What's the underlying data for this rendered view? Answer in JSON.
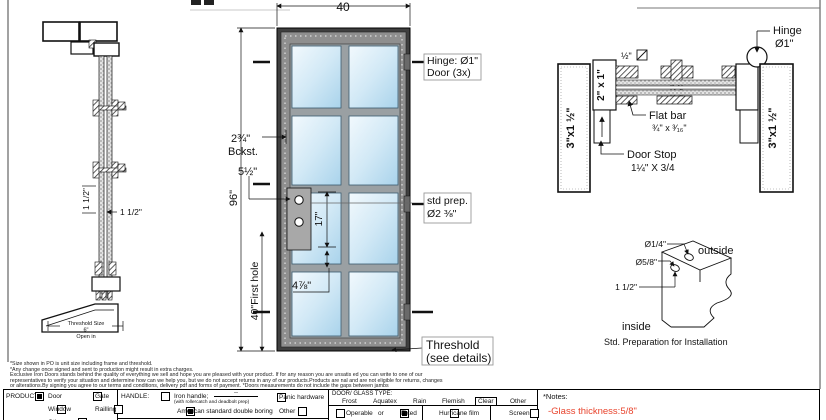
{
  "colors": {
    "frame_dark": "#3f3f3f",
    "frame_face": "#8f8f8f",
    "glass_light": "#f2f9fd",
    "glass_dark": "#a9d3eb",
    "note_red": "#e8432c"
  },
  "drawing": {
    "left": {
      "v_dim": "1 1/2\"",
      "h_dim": "1 1/2\"",
      "th1": "Threshold Size",
      "th2": "6\"",
      "th3": "Open in"
    },
    "door": {
      "dim_w": "40",
      "dim_h": "96\"",
      "backset_v": "2¾\"",
      "backset_l": "Bckst.",
      "off55": "5½\"",
      "d17": "17\"",
      "d478": "4⅞\"",
      "first_hole": "40\"First hole",
      "hinge1": "Hinge: Ø1\"",
      "hinge2": "Door (3x)",
      "prep1": "std prep.",
      "prep2": "Ø2 ⅜\"",
      "thr1": "Threshold",
      "thr2": "(see details)"
    },
    "plan": {
      "jamb_l": "3\"x1 ½\"",
      "jamb_r": "3\"x1 ½\"",
      "tube": "2\" x 1\"",
      "half": "½\"",
      "flat1": "Flat bar",
      "flat2": "¾\" x ³⁄₁₆\"",
      "stop1": "Door Stop",
      "stop2": "1¼\" X 3/4",
      "hinge1": "Hinge",
      "hinge2": "Ø1\""
    },
    "detail": {
      "dia14": "Ø1/4\"",
      "dia58": "Ø5/8\"",
      "d112": "1 1/2\"",
      "outside": "outside",
      "inside": "inside",
      "caption": "Std. Preparation for Installation"
    }
  },
  "fine_print": {
    "l1": "*Size shown in PO is unit size including frame and threshold.",
    "l2": "*Any change once signed and sent to production might result in extra charges.",
    "l3": "Exclusive Iron Doors stands behind the quality of everything we sell and hope you are pleased with your product. If for any reason you are unsatis ed you can write to one of our",
    "l4": "representatives to verify your situation and determine how can we help you, but we do not accept returns in any of our products.Products are  nal and are not eligible for returns, changes",
    "l5": "or alterations.By signing you agree to our terms and conditions, delivery pdf and forms of payment. *Doors measurements do not include the gaps between jambs"
  },
  "form": {
    "product": {
      "label": "PRODUCT:",
      "options": [
        {
          "label": "Door",
          "checked": true
        },
        {
          "label": "Gate",
          "checked": false
        },
        {
          "label": "Window",
          "checked": false
        },
        {
          "label": "Railling",
          "checked": false
        },
        {
          "label": "Other",
          "checked": false
        }
      ]
    },
    "handle": {
      "label": "HANDLE:",
      "options": [
        {
          "label": "Iron handle;",
          "blank": "--",
          "sub": "(with rollercatch and deadbolt prep)",
          "checked": false
        },
        {
          "label": "American standard double boring",
          "checked": true
        },
        {
          "label": "Panic hardware",
          "checked": false
        },
        {
          "label": "Other",
          "checked": false
        }
      ],
      "color_label": "COLOR:"
    },
    "glass": {
      "label": "DOOR/ GLASS TYPE:",
      "types": [
        {
          "label": "Frost",
          "selected": false
        },
        {
          "label": "Aquatex",
          "selected": false
        },
        {
          "label": "Rain",
          "selected": false
        },
        {
          "label": "Flemish",
          "selected": false
        },
        {
          "label": "Clear",
          "selected": true
        },
        {
          "label": "Other",
          "selected": false
        }
      ],
      "fixed_row": {
        "operable": "Operable",
        "or": "or",
        "fixed": "Fixed",
        "operable_checked": false,
        "fixed_checked": true,
        "hurricane": "Hurricane film",
        "screen": "Screen"
      }
    },
    "notes": {
      "label": "*Notes:",
      "note": "-Glass thickness:5/8\"",
      "color": "#e8432c"
    }
  }
}
